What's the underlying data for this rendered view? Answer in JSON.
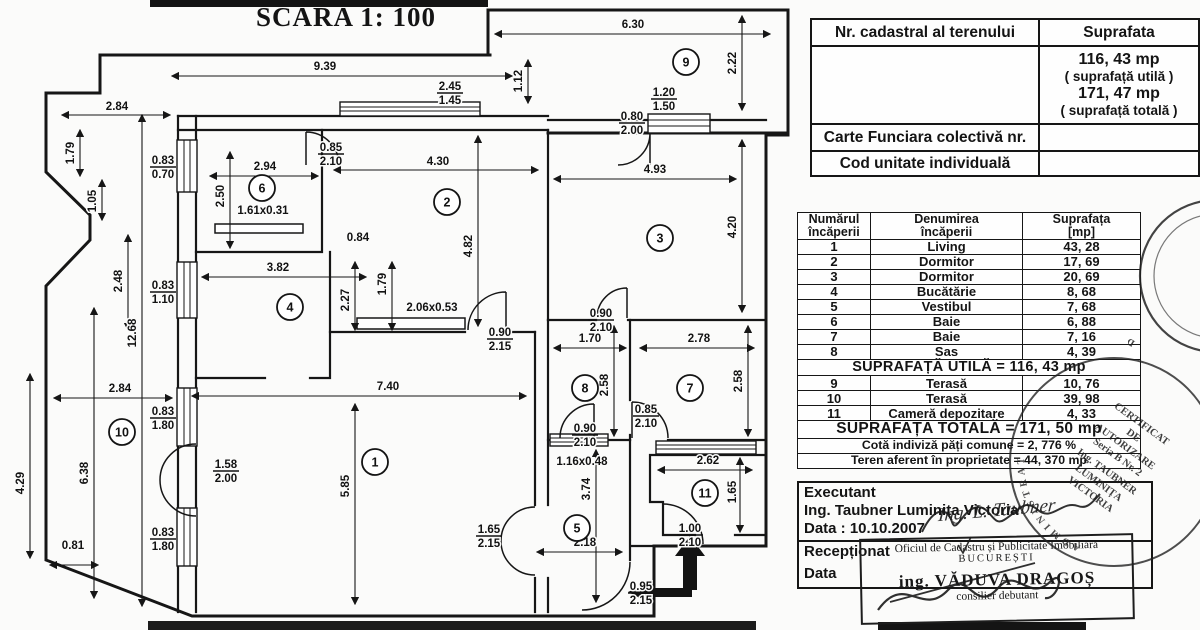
{
  "title": "SCARA 1: 100",
  "colors": {
    "ink": "#141414",
    "paper": "#fbfbfa"
  },
  "cadastral_table": {
    "col1_header": "Nr. cadastral al terenului",
    "col2_header": "Suprafata",
    "suprafata_lines": [
      "116, 43 mp",
      "( suprafață utilă )",
      "171, 47 mp",
      "( suprafață totală )"
    ],
    "row_carte": "Carte Funciara colectivă nr.",
    "row_cod": "Cod unitate individuală"
  },
  "rooms_table": {
    "headers": {
      "col1a": "Numărul",
      "col1b": "încăperii",
      "col2a": "Denumirea",
      "col2b": "încăperii",
      "col3a": "Suprafața",
      "col3b": "[mp]"
    },
    "rows": [
      {
        "nr": "1",
        "name": "Living",
        "area": "43, 28"
      },
      {
        "nr": "2",
        "name": "Dormitor",
        "area": "17, 69"
      },
      {
        "nr": "3",
        "name": "Dormitor",
        "area": "20, 69"
      },
      {
        "nr": "4",
        "name": "Bucătărie",
        "area": "8, 68"
      },
      {
        "nr": "5",
        "name": "Vestibul",
        "area": "7, 68"
      },
      {
        "nr": "6",
        "name": "Baie",
        "area": "6, 88"
      },
      {
        "nr": "7",
        "name": "Baie",
        "area": "7, 16"
      },
      {
        "nr": "8",
        "name": "Sas",
        "area": "4, 39"
      }
    ],
    "subtotal": "SUPRAFAȚĂ UTILĂ =  116, 43  mp",
    "rows2": [
      {
        "nr": "9",
        "name": "Terasă",
        "area": "10, 76"
      },
      {
        "nr": "10",
        "name": "Terasă",
        "area": "39, 98"
      },
      {
        "nr": "11",
        "name": "Cameră depozitare",
        "area": "4, 33"
      }
    ],
    "total": "SUPRAFAȚA TOTALĂ =  171, 50  mp",
    "cota": "Cotă indiviză păți comune = 2, 776 %",
    "teren": "Teren aferent în proprietate = 44, 370 mp"
  },
  "executant": {
    "label": "Executant",
    "name": "Ing. Taubner Luminița Victoria",
    "date": "Data : 10.10.2007",
    "signature": "Ing. L. Taubner",
    "receptionat": "Recepționat",
    "data2": "Data"
  },
  "stamps": {
    "rect_line1": "Oficiul de Cadastru și Publicitate Imobiliară",
    "rect_line2": "BUCUREȘTI",
    "rect_line3": "ing. VĂDUVA DRAGOȘ",
    "rect_line4": "consilier debutant",
    "round_small_arc": "DE CADASTRU",
    "round_big_arc": "ADMINISTRAT",
    "round_big_lines": [
      "CERTIFICAT",
      "DE",
      "AUTORIZARE",
      "Seria B Nr. 2",
      "Ing. TAUBNER",
      "LUMINIȚA",
      "VICTORIA"
    ]
  },
  "plan": {
    "rooms": [
      {
        "n": "1",
        "x": 375,
        "y": 462
      },
      {
        "n": "2",
        "x": 447,
        "y": 202
      },
      {
        "n": "3",
        "x": 660,
        "y": 238
      },
      {
        "n": "4",
        "x": 290,
        "y": 307
      },
      {
        "n": "5",
        "x": 577,
        "y": 528
      },
      {
        "n": "6",
        "x": 262,
        "y": 188
      },
      {
        "n": "7",
        "x": 690,
        "y": 388
      },
      {
        "n": "8",
        "x": 585,
        "y": 388
      },
      {
        "n": "9",
        "x": 686,
        "y": 62
      },
      {
        "n": "10",
        "x": 122,
        "y": 432
      },
      {
        "n": "11",
        "x": 705,
        "y": 493
      }
    ],
    "dims": [
      {
        "t": "9.39",
        "x": 325,
        "y": 70
      },
      {
        "t": "6.30",
        "x": 633,
        "y": 28
      },
      {
        "t": "2.84",
        "x": 117,
        "y": 110
      },
      {
        "t": "1.79",
        "x": 74,
        "y": 153,
        "r": -90
      },
      {
        "t": "1.05",
        "x": 96,
        "y": 201,
        "r": -90
      },
      {
        "t": "2.48",
        "x": 122,
        "y": 281,
        "r": -90
      },
      {
        "t": "12.68",
        "x": 136,
        "y": 333,
        "r": -90
      },
      {
        "t": "1.12",
        "x": 522,
        "y": 81,
        "r": -90
      },
      {
        "t": "2.22",
        "x": 736,
        "y": 63,
        "r": -90
      },
      {
        "t": "2.94",
        "x": 265,
        "y": 170
      },
      {
        "t": "2.50",
        "x": 224,
        "y": 196,
        "r": -90
      },
      {
        "t": "4.30",
        "x": 438,
        "y": 165
      },
      {
        "t": "4.93",
        "x": 655,
        "y": 173
      },
      {
        "t": "4.20",
        "x": 736,
        "y": 227,
        "r": -90
      },
      {
        "t": "0.84",
        "x": 358,
        "y": 241
      },
      {
        "t": "4.82",
        "x": 472,
        "y": 246,
        "r": -90
      },
      {
        "t": "3.82",
        "x": 278,
        "y": 271
      },
      {
        "t": "2.27",
        "x": 349,
        "y": 300,
        "r": -90
      },
      {
        "t": "1.79",
        "x": 386,
        "y": 284,
        "r": -90
      },
      {
        "t": "1.61x0.31",
        "x": 263,
        "y": 214
      },
      {
        "t": "2.06x0.53",
        "x": 432,
        "y": 311
      },
      {
        "t": "2.84",
        "x": 120,
        "y": 392
      },
      {
        "t": "7.40",
        "x": 388,
        "y": 390
      },
      {
        "t": "1.70",
        "x": 590,
        "y": 342
      },
      {
        "t": "2.78",
        "x": 699,
        "y": 342
      },
      {
        "t": "2.58",
        "x": 608,
        "y": 385,
        "r": -90
      },
      {
        "t": "2.58",
        "x": 742,
        "y": 381,
        "r": -90
      },
      {
        "t": "6.38",
        "x": 88,
        "y": 473,
        "r": -90
      },
      {
        "t": "4.29",
        "x": 24,
        "y": 483,
        "r": -90
      },
      {
        "t": "5.85",
        "x": 349,
        "y": 486,
        "r": -90
      },
      {
        "t": "3.74",
        "x": 590,
        "y": 489,
        "r": -90
      },
      {
        "t": "1.16x0.48",
        "x": 582,
        "y": 465
      },
      {
        "t": "2.18",
        "x": 585,
        "y": 546
      },
      {
        "t": "2.62",
        "x": 708,
        "y": 464
      },
      {
        "t": "1.65",
        "x": 736,
        "y": 492,
        "r": -90
      },
      {
        "t": "0.81",
        "x": 73,
        "y": 549
      }
    ],
    "fracs": [
      {
        "a": "2.45",
        "b": "1.45",
        "x": 450,
        "y": 82
      },
      {
        "a": "1.20",
        "b": "1.50",
        "x": 664,
        "y": 88
      },
      {
        "a": "0.80",
        "b": "2.00",
        "x": 632,
        "y": 112
      },
      {
        "a": "0.83",
        "b": "0.70",
        "x": 163,
        "y": 156
      },
      {
        "a": "0.85",
        "b": "2.10",
        "x": 331,
        "y": 143
      },
      {
        "a": "0.83",
        "b": "1.10",
        "x": 163,
        "y": 281
      },
      {
        "a": "0.90",
        "b": "2.10",
        "x": 601,
        "y": 309
      },
      {
        "a": "0.90",
        "b": "2.15",
        "x": 500,
        "y": 328
      },
      {
        "a": "0.85",
        "b": "2.10",
        "x": 646,
        "y": 405
      },
      {
        "a": "0.90",
        "b": "2.10",
        "x": 585,
        "y": 424
      },
      {
        "a": "0.83",
        "b": "1.80",
        "x": 163,
        "y": 407
      },
      {
        "a": "1.58",
        "b": "2.00",
        "x": 226,
        "y": 460
      },
      {
        "a": "0.83",
        "b": "1.80",
        "x": 163,
        "y": 528
      },
      {
        "a": "1.65",
        "b": "2.15",
        "x": 489,
        "y": 525
      },
      {
        "a": "1.00",
        "b": "2.10",
        "x": 690,
        "y": 524
      },
      {
        "a": "0.95",
        "b": "2.15",
        "x": 641,
        "y": 582
      }
    ]
  }
}
